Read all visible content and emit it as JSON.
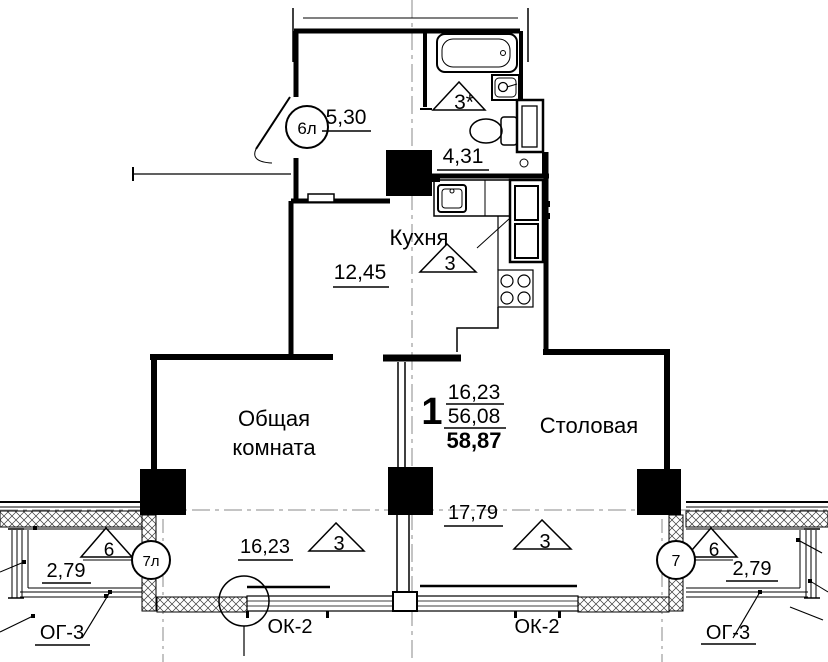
{
  "plan": {
    "apartment": {
      "number": "1",
      "living_area": "16,23",
      "area": "56,08",
      "total_area": "58,87"
    },
    "rooms": {
      "hall": {
        "area": "5,30"
      },
      "bathroom": {
        "mark": "3*",
        "area": "4,31"
      },
      "corridor": {
        "area": "12,45"
      },
      "kitchen": {
        "name": "Кухня",
        "mark": "3"
      },
      "living_room": {
        "name_line1": "Общая",
        "name_line2": "комната",
        "area": "16,23",
        "mark": "3"
      },
      "dining_room": {
        "name": "Столовая",
        "area": "17,79",
        "mark": "3"
      },
      "balcony_left": {
        "mark": "6",
        "area": "2,79"
      },
      "balcony_right": {
        "mark": "6",
        "area": "2,79"
      }
    },
    "doors": {
      "entrance_mark": "6л",
      "balcony_left_mark": "7л",
      "balcony_right_mark": "7"
    },
    "windows": {
      "window_left": "ОК-2",
      "window_right": "ОК-2",
      "glazing_left": "ОГ-3",
      "glazing_right": "ОГ-3"
    }
  },
  "colors": {
    "line": "#000000",
    "axis": "#8a8a8a",
    "background": "#ffffff"
  }
}
